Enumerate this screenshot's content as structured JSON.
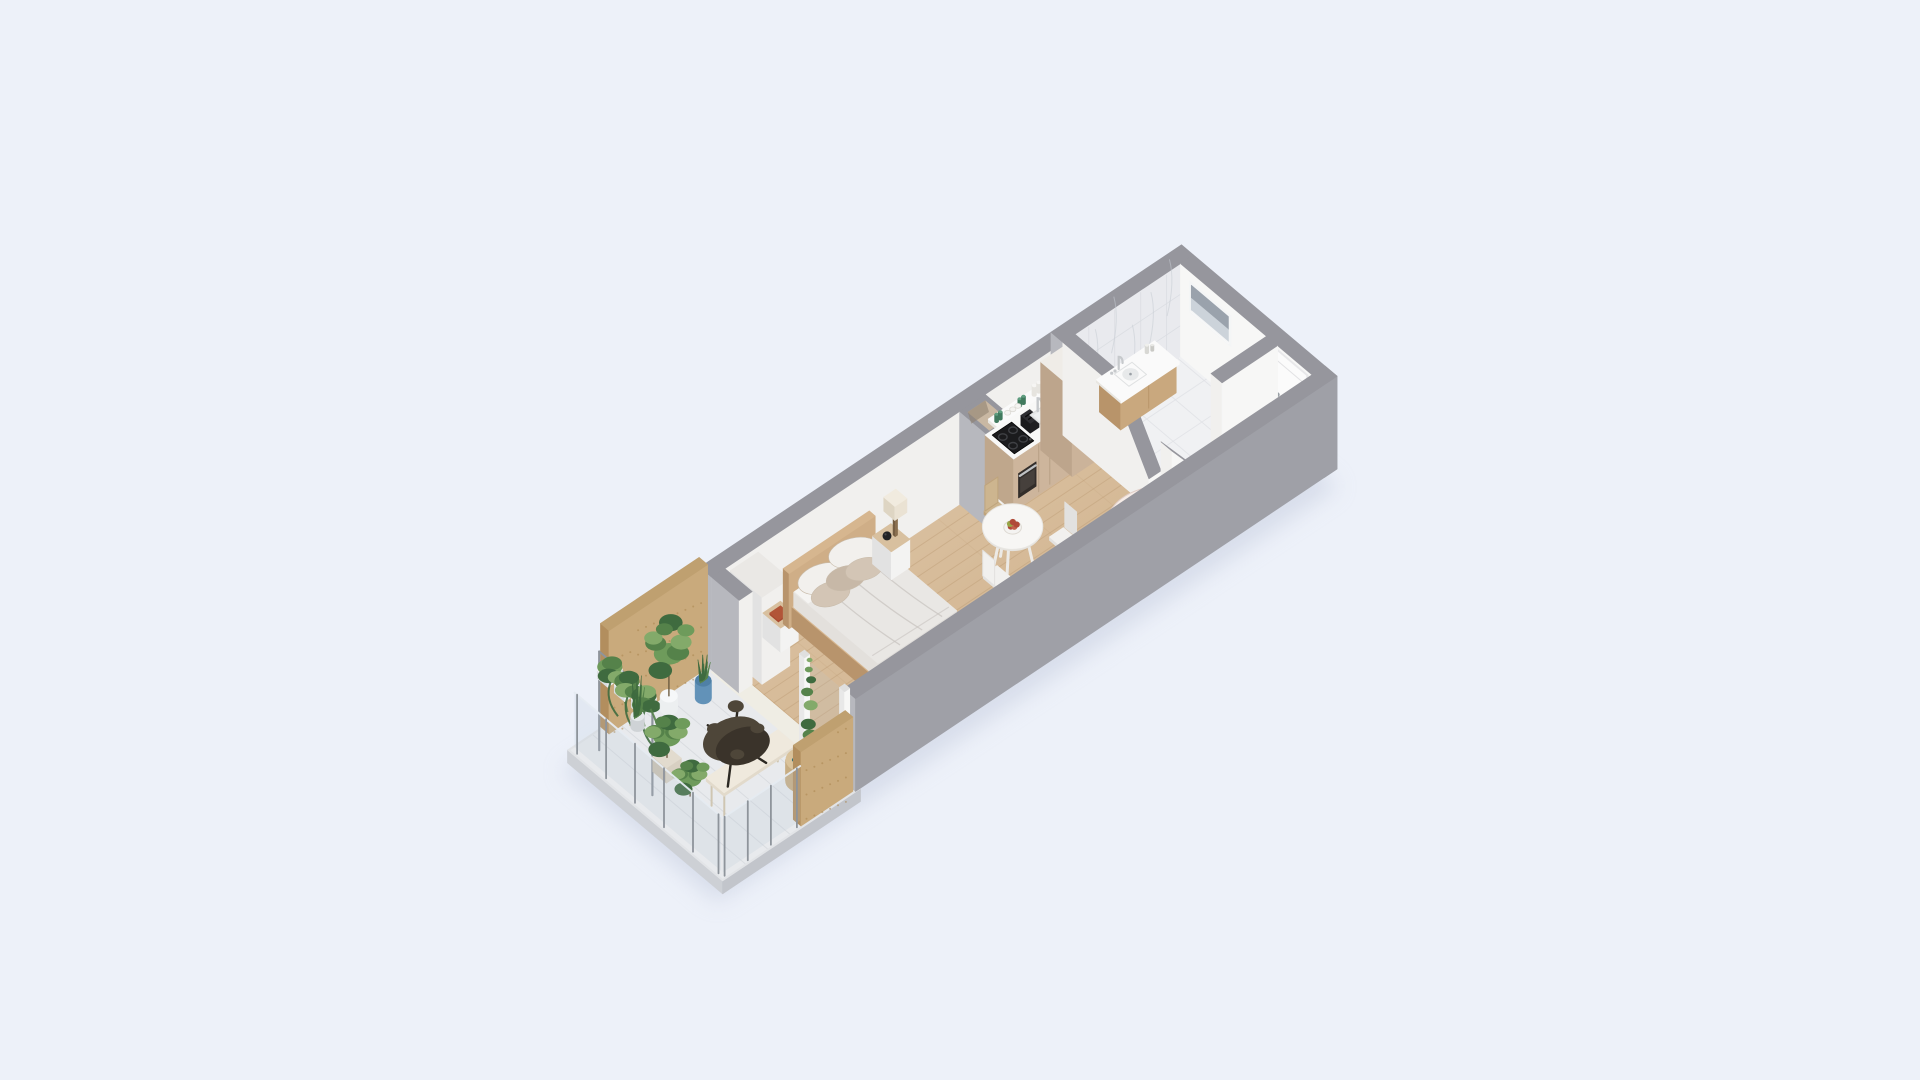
{
  "scene_meta": {
    "description": "isometric-3d-floor-plan-studio-apartment",
    "background": "#edf1f9"
  },
  "projection": {
    "ox": 700,
    "oy": 660,
    "ax": 46.3,
    "ay": -31,
    "bx": 42.6,
    "by": 36,
    "zs": 58
  },
  "palette": {
    "shadow": "#c3cadd",
    "wallTop": "#96969d",
    "wallOuterL": "#b7b8be",
    "wallOuterB": "#9fa0a7",
    "wallInner": "#f1f0ee",
    "wallInnerBright": "#f7f7f6",
    "marble": "#e9eaee",
    "marbleLine": "#d9dce1",
    "marbleVein": "#c7ccd4",
    "woodA": "#e0c9ab",
    "woodB": "#cbab84",
    "woodLine": "#bb9a73",
    "bathFloor": "#f0f1f3",
    "bathFloorLine": "#e0e2e6",
    "balcFloor": "#e8eaed",
    "balcLine": "#d6d9dd",
    "slabL": "#cdd0d5",
    "slabF": "#c2c5cb",
    "slabT": "#e2e4e7",
    "ply": "#c9aa7c",
    "plyDark": "#b28e5e",
    "plyTop": "#bfa070",
    "plyDot": "#a9854f",
    "cab": "#cdb59c",
    "cabSide": "#bfa78c",
    "cabSeam": "#b39c80",
    "counter": "#f8f8f7",
    "counterSide": "#e9e7e2",
    "black": "#1b1b1d",
    "dark2": "#1f1f22",
    "dark3": "#2e2e32",
    "steel": "#c6c9cc",
    "ring": "#3f4044",
    "oven": "#322d2a",
    "ovenGlass": "#46403c",
    "tallcab": "#cbb39a",
    "tallcabSide": "#bda58c",
    "tallcabTop": "#efece7",
    "vanityWood": "#c9a87e",
    "vanityWoodDark": "#b8946a",
    "sinkIn": "#e7e9ea",
    "white": "#fafafa",
    "bedWood": "#cfae87",
    "bedWoodDark": "#b8946c",
    "bedWoodTop": "#d6b68f",
    "duvet": "#e9e7e4",
    "duvetSide": "#dfdcd9",
    "duvetSideL": "#e3e0dc",
    "duvetFold": "#c8c4c0",
    "sheet": "#f5f4f2",
    "pw": "#f2f0ed",
    "pt": "#d3c5b5",
    "pt2": "#c7b8a7",
    "nstand": "#f3f3f2",
    "nstandSide": "#e2e2e2",
    "nstandTop": "#d8c09f",
    "lampPost": "#8a6f4f",
    "lampShade": "#eae2d3",
    "lampShadeSide": "#ded5c3",
    "sphere": "#232325",
    "bookRed": "#a84a31",
    "bookRedTop": "#b25538",
    "bookTeal": "#2f6d74",
    "bookTealTop": "#37767c",
    "tableTop": "#f7f6f4",
    "tableRim": "#e4e2de",
    "tableLeg": "#eceae6",
    "chairSeatW": "#f1f0ee",
    "chairSideW": "#e2e1df",
    "chairLegW": "#d6d5d2",
    "chairSeatWd": "#cdb58f",
    "chairSideWd": "#bfa47c",
    "chairLegWd": "#b09468",
    "sofa": "#ecdad4",
    "sofaLight": "#f2e5e0",
    "sofaDark": "#ddc7c0",
    "sofaPillow": "#f6ece7",
    "sofaPillow2": "#e5cfc8",
    "benchHall": "#f4f4f3",
    "benchHallSide": "#e6e6e5",
    "benchHallTop": "#f8f8f7",
    "glass": "#b9c9d9",
    "glassPost": "#8e949b",
    "glassTop": "#e6ecf2",
    "g1": "#6e9b5b",
    "g2": "#55824a",
    "g3": "#3f6b3f",
    "g4": "#83aa6a",
    "stem": "#6b5a3f",
    "potBlue": "#6292b8",
    "potWhite": "#eceff0",
    "potGray": "#cfd3d6",
    "stool": "#d8d0c2",
    "btfly": "#4e4639",
    "btflyDark": "#3a332a",
    "btflyLeg": "#2c2822",
    "balcBench": "#efe9dd",
    "balcBenchSide": "#e2dacb",
    "balcBenchLeg": "#cfc6b2",
    "sideTable": "#d9c29b",
    "sideTableSide": "#c7ad83",
    "doorFill": "#fbfbfb",
    "doorFrame": "#e8e8ea",
    "doorLine": "#e2e2e4",
    "handle": "#9aa0a6",
    "winFrame": "#f4f5f6",
    "winGlassTop": "#9aa2ac",
    "winGlassBot": "#ccd3da",
    "shaftIn": "#c9b8a3",
    "shaftInDark": "#8d7f6e",
    "a1": "#b04a38",
    "a2": "#97a647",
    "a3": "#c2614b",
    "bowl": "#f4f3f1",
    "glassGreen": "#5f9e80",
    "glassGreenD": "#417a5e",
    "canister": "#f6f5f3",
    "threshold": "#efede4"
  },
  "scene": [
    {
      "n": "building-shadow",
      "t": "shadow",
      "u1": -2.95,
      "v1": 0.15,
      "u2": 10.45,
      "v2": 3.8
    },
    {
      "n": "balcony-slab",
      "t": "box",
      "u1": -2.88,
      "v1": 0.02,
      "u2": 0.1,
      "v2": 3.66,
      "z1": -0.22,
      "z2": 0,
      "l": "slabL",
      "f": "slabF",
      "tp": "slabT"
    },
    {
      "n": "balcony-floor",
      "t": "floor",
      "u1": -2.84,
      "v1": 0.06,
      "u2": 0.02,
      "v2": 3.62,
      "f": "balcFloor",
      "linesU": 0.48,
      "lineC": "balcLine",
      "lineOp": 0.8
    },
    {
      "n": "threshold-strip",
      "t": "floor",
      "u1": -0.04,
      "v1": 0.3,
      "u2": 0.3,
      "v2": 3.4,
      "f": "threshold"
    },
    {
      "n": "main-floor-wood",
      "t": "floor",
      "u1": 0.28,
      "v1": 0.28,
      "u2": 7.58,
      "v2": 3.37,
      "f": "url(#woodg)",
      "linesV": 0.23,
      "lineC": "woodLine",
      "lineOp": 0.42,
      "linesU": 1.15,
      "lineOp2": 0.16
    },
    {
      "n": "hallway-floor-wood",
      "t": "floor",
      "u1": 7.58,
      "v1": 2.3,
      "u2": 10.12,
      "v2": 3.37,
      "f": "url(#woodg)",
      "linesV": 0.23,
      "lineC": "woodLine",
      "lineOp": 0.42
    },
    {
      "n": "bathroom-floor-marble",
      "t": "floor",
      "u1": 7.58,
      "v1": 0.28,
      "u2": 10.12,
      "v2": 2.3,
      "f": "bathFloor",
      "linesU": 0.62,
      "linesV": 0.62,
      "lineC": "bathFloorLine",
      "lineOp": 0.8,
      "lineOp2": 0.8
    },
    {
      "n": "wall-top-main",
      "t": "box",
      "u1": 0,
      "v1": 0,
      "u2": 7.58,
      "v2": 0.28,
      "z2": 1.6,
      "l": "wallOuterL",
      "f": "wallInner",
      "tp": "wallTop"
    },
    {
      "n": "wall-top-bathroom-marble",
      "t": "marbleWall",
      "u1": 7.58,
      "v1": 0,
      "u2": 10.4,
      "v2": 0.28,
      "z2": 1.6
    },
    {
      "n": "wall-end-right",
      "t": "box",
      "u1": 10.12,
      "v1": 0.28,
      "u2": 10.4,
      "v2": 3.65,
      "z2": 1.6,
      "l": "wallInnerBright",
      "f": "wallOuterB",
      "tp": "wallTop"
    },
    {
      "n": "bathroom-window",
      "t": "window",
      "u": 10.115,
      "v1": 0.55,
      "v2": 1.42,
      "z1": 0.95,
      "z2": 1.4
    },
    {
      "n": "entry-door",
      "t": "door",
      "u": 10.115,
      "v1": 2.46,
      "v2": 3.24,
      "z1": 0,
      "z2": 1.54
    },
    {
      "n": "vent-shaft-column",
      "t": "shaft",
      "u1": 5.35,
      "v1": 0.28,
      "u2": 5.9,
      "v2": 0.98,
      "z2": 1.6
    },
    {
      "n": "kitchen-shelf",
      "t": "box",
      "u1": 5.95,
      "v1": 0.3,
      "u2": 7.4,
      "v2": 0.56,
      "z1": 1.1,
      "z2": 1.16,
      "l": "counterSide",
      "f": "counter",
      "tp": "white"
    },
    {
      "n": "kitchen-shelf-items",
      "t": "shelfItems",
      "z": 1.16,
      "greens": [
        [
          6.02,
          0.42
        ],
        [
          6.1,
          0.42
        ],
        [
          6.52,
          0.42
        ],
        [
          6.6,
          0.42
        ]
      ],
      "bowls": [
        [
          6.25,
          0.43
        ],
        [
          6.36,
          0.43
        ],
        [
          6.47,
          0.43
        ]
      ],
      "cans": [
        [
          6.85,
          0.4
        ],
        [
          6.95,
          0.4
        ]
      ]
    },
    {
      "n": "kitchen-cabinets",
      "t": "box",
      "u1": 5.9,
      "v1": 0.28,
      "u2": 7.1,
      "v2": 0.95,
      "z2": 0.9,
      "l": "cabSide",
      "f": "cab",
      "tp": "counter"
    },
    {
      "n": "kitchen-cabinet-seams",
      "t": "vlinesV",
      "v": 0.952,
      "us": [
        6.44,
        6.68
      ],
      "z1": 0.05,
      "z2": 0.86,
      "c": "cabSeam"
    },
    {
      "n": "kitchen-cooktop",
      "t": "cooktop",
      "u1": 5.98,
      "v1": 0.36,
      "u2": 6.4,
      "v2": 0.88,
      "z": 0.905
    },
    {
      "n": "kitchen-oven",
      "t": "oven",
      "v": 0.955,
      "u1": 6.0,
      "u2": 6.38,
      "z1": 0.18,
      "z2": 0.6
    },
    {
      "n": "kitchen-toaster",
      "t": "toaster",
      "u1": 6.47,
      "v1": 0.5,
      "u2": 6.66,
      "v2": 0.72,
      "z1": 0.9,
      "z2": 1.07
    },
    {
      "n": "kitchen-sink",
      "t": "sinkK",
      "u1": 6.72,
      "v1": 0.44,
      "u2": 7.0,
      "v2": 0.8,
      "z": 0.905,
      "fau": [
        6.87,
        0.46
      ]
    },
    {
      "n": "kitchen-tall-cabinet",
      "t": "box",
      "u1": 7.1,
      "v1": 0.28,
      "u2": 7.58,
      "v2": 1.02,
      "z2": 1.52,
      "l": "tallcabSide",
      "f": "tallcab",
      "tp": "tallcabTop"
    },
    {
      "n": "divider-wall",
      "t": "divider",
      "u1": 7.58,
      "u2": 7.84,
      "v1": 0.28,
      "v2": 2.3,
      "zFull": 1.6,
      "zLow": 0.5,
      "vBreak": 1.45
    },
    {
      "n": "bathroom-vanity",
      "t": "vanity",
      "u1": 8.35,
      "u2": 9.55,
      "v1": 0.28,
      "v2": 0.82,
      "z": 0.5
    },
    {
      "n": "bathroom-partition-stub",
      "t": "sboxU",
      "u1": 7.84,
      "u2": 8.42,
      "v1": 2.3,
      "v2": 2.56,
      "z2a": 1.0,
      "z2b": 0.35,
      "l": "wallInner",
      "f": "wallInnerBright",
      "tp": "wallTop"
    },
    {
      "n": "bathroom-partition-wall",
      "t": "box",
      "u1": 8.92,
      "v1": 2.3,
      "u2": 10.12,
      "v2": 2.56,
      "z2": 1.6,
      "l": "wallInner",
      "f": "wallInnerBright",
      "tp": "wallTop"
    },
    {
      "n": "hallway-bench",
      "t": "box",
      "u1": 8.55,
      "v1": 2.95,
      "u2": 9.95,
      "v2": 3.3,
      "z2": 0.42,
      "l": "benchHallSide",
      "f": "benchHall",
      "tp": "benchHallTop"
    },
    {
      "n": "hallway-bench-seam",
      "t": "vlinesV",
      "v": 3.302,
      "us": [
        9.25
      ],
      "z1": 0.03,
      "z2": 0.4,
      "c": "benchHallSide"
    },
    {
      "n": "wardrobe",
      "t": "box",
      "u1": 0.4,
      "v1": 0.28,
      "u2": 1.0,
      "v2": 1.02,
      "z2": 1.5,
      "l": "nstandSide",
      "f": "wallInner",
      "tp": "#eae8e5"
    },
    {
      "n": "nightstand-left",
      "t": "box",
      "u1": 1.08,
      "v1": 0.3,
      "u2": 1.46,
      "v2": 0.72,
      "z2": 0.42,
      "l": "nstandSide",
      "f": "nstand",
      "tp": "nstandTop"
    },
    {
      "n": "book-red",
      "t": "box",
      "u1": 1.14,
      "v1": 0.4,
      "u2": 1.37,
      "v2": 0.6,
      "z1": 0.42,
      "z2": 0.45,
      "l": "bookRed",
      "f": "bookRed",
      "tp": "bookRedTop"
    },
    {
      "n": "bed",
      "t": "bed",
      "hb": [
        1.52,
        3.38,
        0.3,
        0.44,
        0.95
      ],
      "plat": [
        1.58,
        3.32,
        0.44,
        2.52,
        0.34
      ],
      "mat": [
        1.6,
        3.3,
        0.46,
        2.44,
        0.6
      ]
    },
    {
      "n": "bed-pillows",
      "t": "pillows",
      "list": [
        [
          2.0,
          0.72,
          0.78,
          26,
          15,
          -16,
          "pw"
        ],
        [
          2.72,
          0.66,
          0.8,
          26,
          15,
          -14,
          "pw"
        ],
        [
          1.92,
          0.98,
          0.72,
          20,
          12,
          -18,
          "pt"
        ],
        [
          2.32,
          0.9,
          0.73,
          20,
          12,
          -15,
          "pt2"
        ],
        [
          2.68,
          0.94,
          0.72,
          19,
          11,
          -15,
          "pt"
        ]
      ]
    },
    {
      "n": "nightstand-right",
      "t": "box",
      "u1": 3.45,
      "v1": 0.3,
      "u2": 3.85,
      "v2": 0.74,
      "z2": 0.48,
      "l": "nstandSide",
      "f": "nstand",
      "tp": "nstandTop"
    },
    {
      "n": "vase-sphere",
      "t": "sphere",
      "u": 3.56,
      "v": 0.52,
      "z": 0.56,
      "r": 0.075
    },
    {
      "n": "table-lamp",
      "t": "lamp",
      "u": 3.74,
      "v": 0.52,
      "z": 0.48
    },
    {
      "n": "dining-chair-top",
      "t": "chair",
      "u": 5.3,
      "v": 1.22,
      "back": "-v",
      "col": "wood"
    },
    {
      "n": "dining-table",
      "t": "table",
      "u": 5.05,
      "v": 1.85,
      "r": 0.48,
      "z": 0.72
    },
    {
      "n": "fruit-bowl",
      "t": "bowlF",
      "u": 5.05,
      "v": 1.85,
      "z": 0.735
    },
    {
      "n": "dining-chair-left",
      "t": "chair",
      "u": 4.38,
      "v": 2.2,
      "back": "-u",
      "col": "white"
    },
    {
      "n": "dining-chair-right",
      "t": "chair",
      "u": 5.72,
      "v": 2.3,
      "back": "+u",
      "col": "white"
    },
    {
      "n": "sofa",
      "t": "sofa",
      "u1": 5.9,
      "u2": 7.4,
      "v1": 2.52,
      "v2": 3.36
    },
    {
      "n": "wall-bottom",
      "t": "box",
      "u1": 0,
      "v1": 3.37,
      "u2": 10.4,
      "v2": 3.65,
      "z2": 1.6,
      "l": "wallOuterL",
      "f": "wallOuterB",
      "tp": "wallTop"
    },
    {
      "n": "left-wall-stub",
      "t": "box",
      "u1": 0,
      "v1": 0.28,
      "u2": 0.28,
      "v2": 0.92,
      "z2": 1.6,
      "l": "wallOuterL",
      "f": "wallInner",
      "tp": "wallTop"
    },
    {
      "n": "balcony-door-glass",
      "t": "fUq",
      "u": 0.12,
      "v1": 2.42,
      "v2": 3.2,
      "z1": 0.05,
      "z2": 1.42,
      "f": "glass",
      "op": 0.15
    },
    {
      "n": "balcony-door-post-1",
      "t": "box",
      "u1": 0.05,
      "v1": 2.28,
      "u2": 0.16,
      "v2": 2.4,
      "z2": 1.5,
      "l": "#e8e8e8",
      "f": "#f7f7f6",
      "tp": "#dfdfdf"
    },
    {
      "n": "balcony-door-post-2",
      "t": "box",
      "u1": 0.05,
      "v1": 3.22,
      "u2": 0.16,
      "v2": 3.34,
      "z2": 1.5,
      "l": "#e8e8e8",
      "f": "#f7f7f6",
      "tp": "#dfdfdf"
    },
    {
      "n": "plywood-accent-wall",
      "t": "plywood",
      "u1": -2.15,
      "v1": 0.0,
      "u2": -0.02,
      "v2": 0.2,
      "z2": 1.78
    },
    {
      "n": "hanging-plant-stand",
      "t": "hangstand",
      "u": -2.5,
      "v1": 0.35,
      "v2": 1.6,
      "z": 1.7,
      "hangs": [
        0.6,
        1.0,
        1.4
      ]
    },
    {
      "n": "sansevieria-plant",
      "t": "spiky",
      "u": -1.7,
      "v": 0.38,
      "z": 0.18,
      "h": 0.7,
      "pot": "potGray",
      "pr": 0.11,
      "ph": 0.18
    },
    {
      "n": "dieffenbachia-plant",
      "t": "plant",
      "u": -1.15,
      "v": 0.52,
      "z": 0.1,
      "s": 0.55,
      "h": 1.45,
      "pot": "potWhite",
      "pr": 0.14,
      "ph": 0.22
    },
    {
      "n": "blue-pot-plant",
      "t": "spiky",
      "u": -0.5,
      "v": 0.62,
      "z": 0.3,
      "h": 0.42,
      "pot": "potBlue",
      "pr": 0.13,
      "ph": 0.3
    },
    {
      "n": "plant-stool",
      "t": "box",
      "u1": -2.16,
      "v1": 1.24,
      "u2": -1.84,
      "v2": 1.56,
      "z2": 0.26,
      "l": "#cbc2b2",
      "f": "stool",
      "tp": "#e2dbce"
    },
    {
      "n": "balcony-bush",
      "t": "plant",
      "u": -2.0,
      "v": 1.4,
      "z": 0.26,
      "s": 0.5,
      "h": 0.7
    },
    {
      "n": "bench-end-plant",
      "t": "plant",
      "u": -2.1,
      "v": 2.05,
      "z": 0.05,
      "s": 0.42,
      "h": 0.6
    },
    {
      "n": "balcony-bench",
      "t": "bbench",
      "u1": -2.0,
      "u2": -0.45,
      "v1": 2.32,
      "v2": 2.74,
      "z": 0.42
    },
    {
      "n": "balcony-side-table",
      "t": "cylT",
      "u": -0.5,
      "v": 2.92,
      "r": 0.25,
      "z2": 0.36,
      "side": "sideTableSide",
      "top": "sideTable"
    },
    {
      "n": "book-teal",
      "t": "box",
      "u1": -0.62,
      "v1": 2.84,
      "u2": -0.4,
      "v2": 3.0,
      "z1": 0.36,
      "z2": 0.385,
      "l": "bookTeal",
      "f": "bookTeal",
      "tp": "bookTealTop"
    },
    {
      "n": "butterfly-chair",
      "t": "butterfly",
      "u": -1.05,
      "v": 2.0
    },
    {
      "n": "tall-balcony-plant",
      "t": "plant",
      "u": -0.42,
      "v": 3.02,
      "z": 0,
      "s": 0.42,
      "h": 1.5,
      "tall": true,
      "pot": "potGray",
      "pr": 0.12,
      "ph": 0.2
    },
    {
      "n": "parapet-plywood",
      "t": "plywood",
      "u1": -1.15,
      "v1": 3.44,
      "u2": -0.03,
      "v2": 3.62,
      "z2": 1.28
    },
    {
      "n": "railing-left-glass",
      "t": "railU",
      "u": -2.82,
      "v1": 0.12,
      "v2": 3.56,
      "z": 1.02,
      "posts": [
        0.18,
        0.86,
        1.54,
        2.22,
        2.9,
        3.5
      ]
    },
    {
      "n": "railing-front-glass",
      "t": "railV",
      "v": 3.6,
      "u1": -2.82,
      "u2": -1.15,
      "z": 1.02,
      "posts": [
        -2.78,
        -2.28,
        -1.78,
        -1.22
      ]
    }
  ]
}
